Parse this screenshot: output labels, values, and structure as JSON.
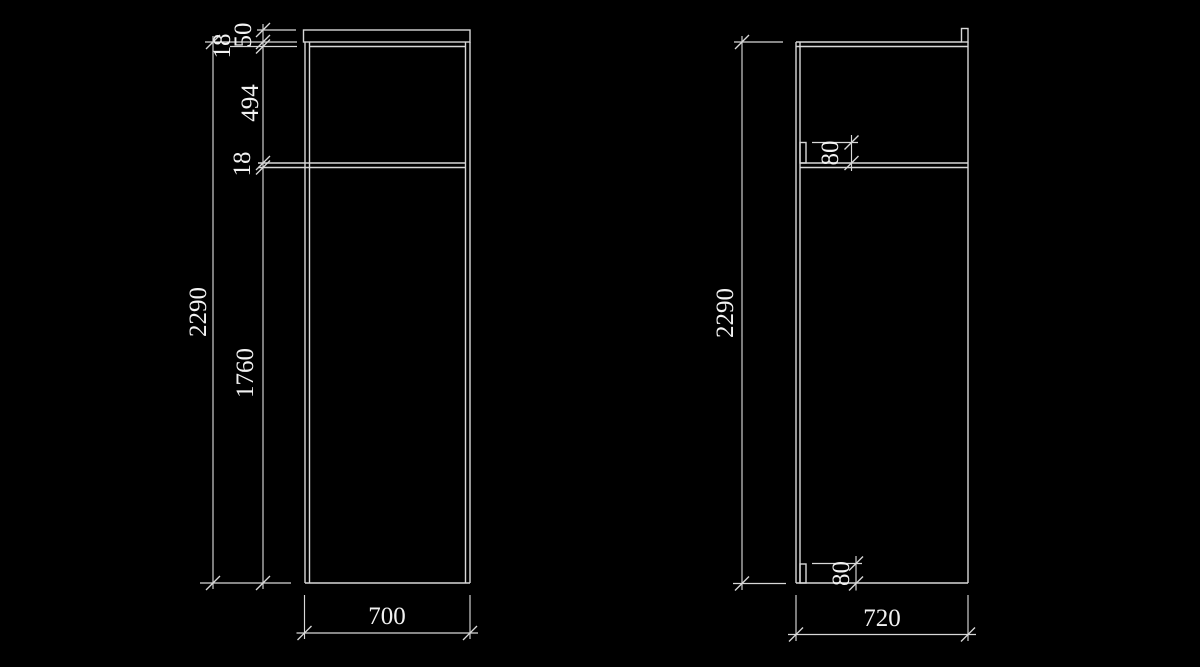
{
  "theme": {
    "background": "#000000",
    "line_color": "#d8d8d8",
    "text_color": "#f2f2f2"
  },
  "front_view": {
    "dimensions": {
      "crown_height": "50",
      "top_panel_thickness": "18",
      "upper_opening_height": "494",
      "shelf_thickness": "18",
      "door_height": "1760",
      "overall_height": "2290",
      "overall_width": "700"
    }
  },
  "side_view": {
    "dimensions": {
      "overall_height": "2290",
      "top_cleat_height": "80",
      "bottom_cleat_height": "80",
      "overall_depth": "720"
    }
  }
}
